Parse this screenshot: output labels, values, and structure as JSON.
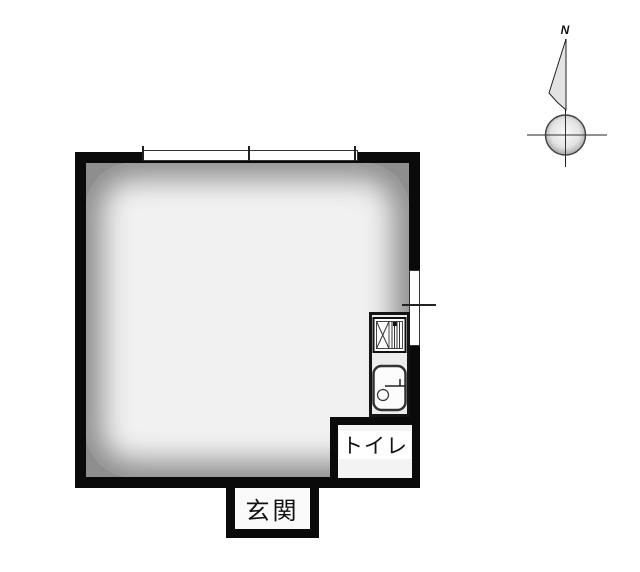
{
  "compass": {
    "north_label": "N"
  },
  "labels": {
    "toilet": "トイレ",
    "entrance": "玄関"
  },
  "fixtures": {
    "top_window": "sliding-window",
    "right_window": "sliding-window",
    "kitchen_stove": "gas-stove-icon",
    "kitchen_sink": "sink-icon"
  },
  "colors": {
    "wall": "#0a0a0a",
    "floor_edge": "#8e8e8e",
    "floor_center": "#f1f1f1",
    "fixture_background": "#ececec",
    "label_background": "#ffffff",
    "text": "#111111",
    "background": "#ffffff"
  }
}
